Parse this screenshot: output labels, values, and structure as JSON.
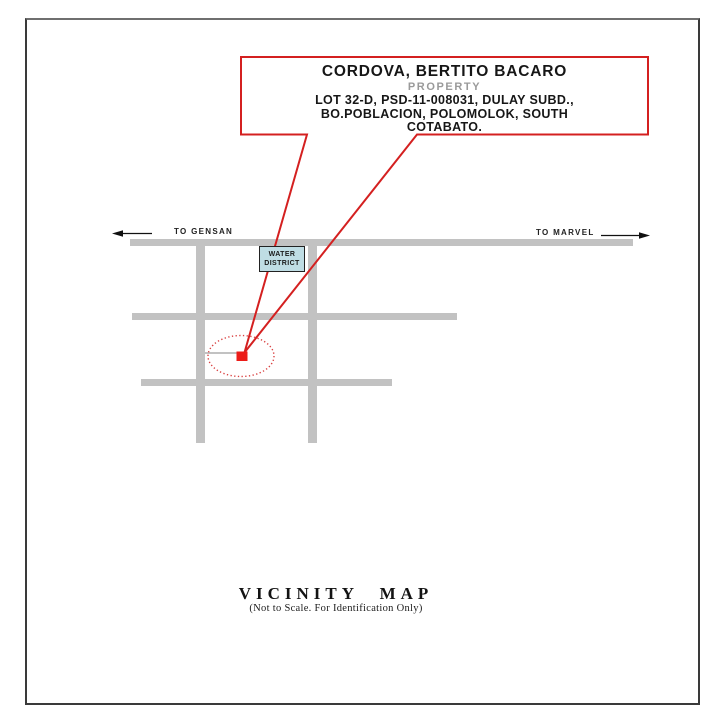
{
  "document": {
    "title_block": {
      "owner": "CORDOVA, BERTITO BACARO",
      "subtitle": "PROPERTY",
      "address_line1": "LOT 32-D, PSD-11-008031, DULAY SUBD.,",
      "address_line2": "BO.POBLACION, POLOMOLOK, SOUTH",
      "address_line3": "COTABATO."
    },
    "map": {
      "direction_left": "TO GENSAN",
      "direction_right": "TO MARVEL",
      "landmark": {
        "line1": "WATER",
        "line2": "DISTRICT"
      }
    },
    "footer": {
      "title": "VICINITY MAP",
      "note": "(Not to Scale. For Identification Only)"
    },
    "colors": {
      "callout_red": "#d42020",
      "marker_red": "#ec1c18",
      "ellipse_red": "#d94040",
      "road_gray": "#c2c2c2",
      "landmark_fill": "#bfdde4",
      "subtitle_gray": "#9a9a9a",
      "arrow_black": "#111111"
    }
  }
}
